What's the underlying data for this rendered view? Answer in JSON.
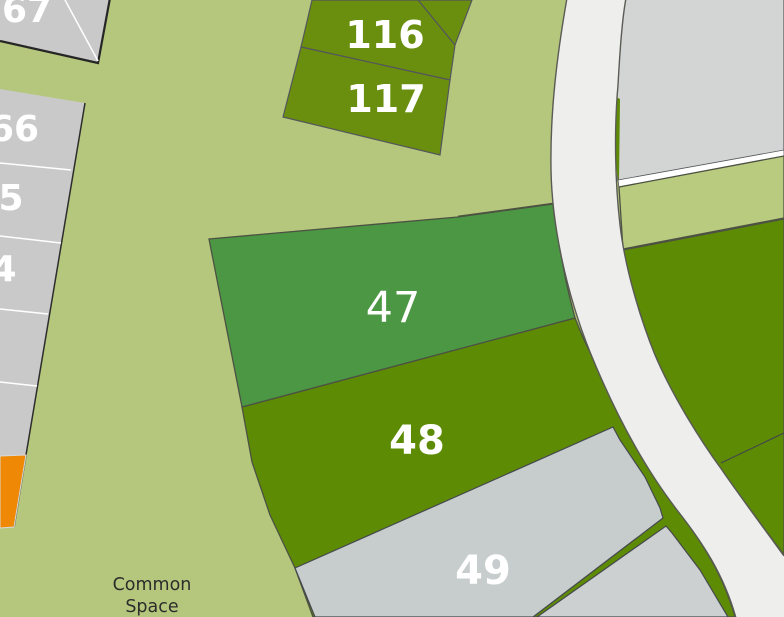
{
  "map": {
    "labels": {
      "p67": "67",
      "p66": "66",
      "p65": "5",
      "p64": "4",
      "p116": "116",
      "p117": "117",
      "p47": "47",
      "p48": "48",
      "p49": "49"
    },
    "common_space": {
      "line1": "Common",
      "line2": "Space"
    },
    "colors": {
      "background": "#b5c77c",
      "olive_plot": "#5e8b04",
      "olive_strip": "#6a8f0e",
      "green_plot": "#4b9743",
      "gray_plot": "#c9c9c9",
      "gray_49": "#c7cccd",
      "gray_bottom_right": "#ccd0d1",
      "gray_top_right": "#d3d5d5",
      "light_green_strip": "#b9cb7e",
      "road": "#eeeeec",
      "road_border": "#5a5b55",
      "plot_border": "#4c5143",
      "orange_plot": "#ef8905",
      "divider_white": "#ffffff",
      "label_text": "#ffffff",
      "common_space_text": "#2c2c2c"
    }
  }
}
